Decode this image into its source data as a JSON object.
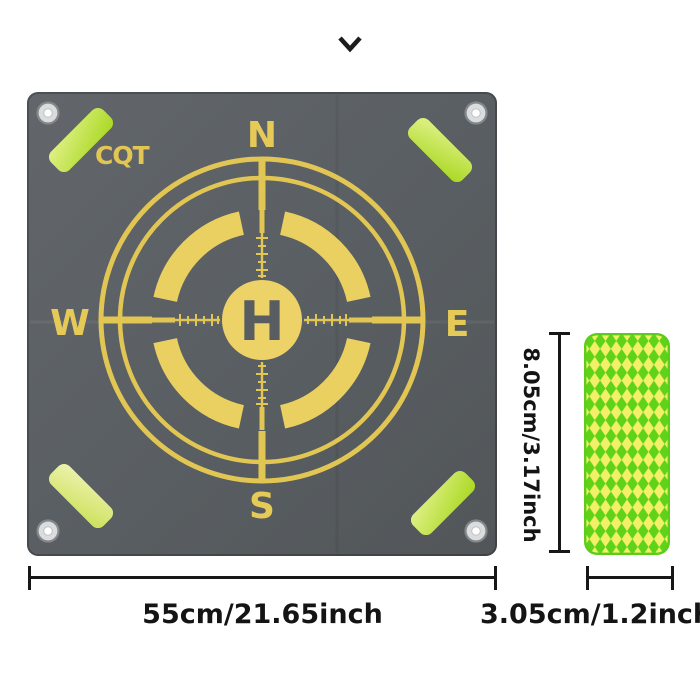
{
  "page": {
    "background_color": "#ffffff"
  },
  "icons": {
    "top_center": "chevron-down"
  },
  "landing_pad": {
    "brand_logo": "CQT",
    "compass": {
      "north": "N",
      "east": "E",
      "south": "S",
      "west": "W"
    },
    "helipad_letter": "H",
    "colors": {
      "surface": "#5a5f63",
      "markings": "#e2c654",
      "strip_bright": "#bfe23a",
      "strip_pale": "#e2ea95",
      "grommet": "#dadcdd"
    }
  },
  "reflective_sticker": {
    "pattern": "green-yellow-diamond-checker",
    "colors": {
      "green": "#5fd318",
      "yellow": "#f2ef68",
      "border": "#5ccd1d"
    }
  },
  "dimensions": {
    "pad_width": "55cm/21.65inch",
    "sticker_height": "8.05cm/3.17inch",
    "sticker_width": "3.05cm/1.2inch"
  }
}
